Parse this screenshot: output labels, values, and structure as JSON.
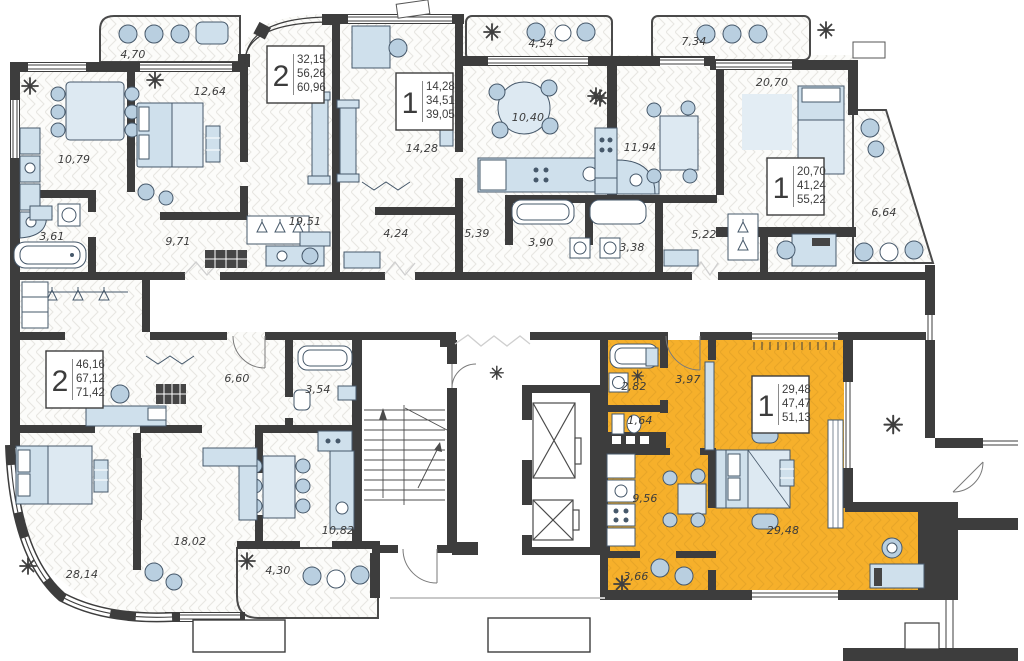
{
  "plan": {
    "title": "residential-floor-plan",
    "colors": {
      "highlight": "#F6B02B",
      "wall": "#3D3D3D"
    },
    "rooms": {
      "balcony_a": "4,70",
      "bedroom_a": "12,64",
      "kitchen_a": "10,79",
      "bath_a": "3,61",
      "hall_a": "9,71",
      "living_a": "19,51",
      "living_b": "14,28",
      "hall_b": "4,24",
      "hall_b2": "5,39",
      "kitchen_b": "10,40",
      "balcony_b": "4,54",
      "bath_b": "3,90",
      "bath_c": "3,38",
      "kitchen_c": "11,94",
      "hall_c": "5,22",
      "balcony_c": "7,34",
      "living_c": "20,70",
      "balcony_c2": "6,64",
      "hall_d": "6,60",
      "bath_d": "3,54",
      "bedroom_d": "28,14",
      "living_d": "18,02",
      "kitchen_d": "10,82",
      "balcony_d": "4,30",
      "bath_e": "2,82",
      "hall_e": "3,97",
      "wc_e": "1,64",
      "kitchen_e": "9,56",
      "living_e": "29,48",
      "entry_e": "3,66"
    },
    "apartments": {
      "a": {
        "rooms": "2",
        "area_living": "32,15",
        "area_base": "56,26",
        "area_total": "60,96"
      },
      "b": {
        "rooms": "1",
        "area_living": "14,28",
        "area_base": "34,51",
        "area_total": "39,05"
      },
      "c": {
        "rooms": "1",
        "area_living": "20,70",
        "area_base": "41,24",
        "area_total": "55,22"
      },
      "d": {
        "rooms": "2",
        "area_living": "46,16",
        "area_base": "67,12",
        "area_total": "71,42"
      },
      "e": {
        "rooms": "1",
        "area_living": "29,48",
        "area_base": "47,47",
        "area_total": "51,13",
        "highlighted": true
      }
    }
  }
}
